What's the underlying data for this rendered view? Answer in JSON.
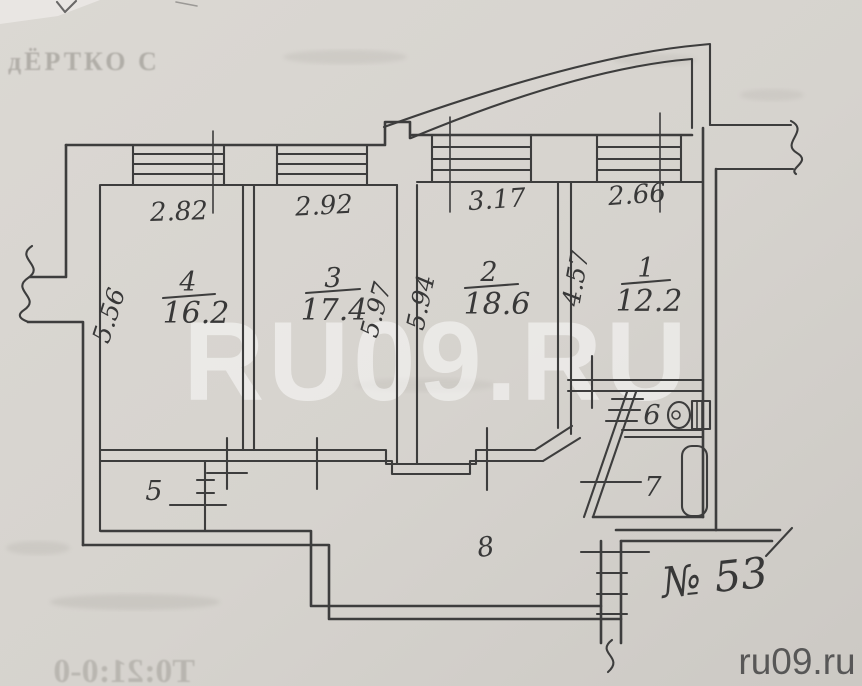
{
  "document": {
    "kind": "scanned apartment floor plan",
    "apartment_no": "№ 53"
  },
  "plan": {
    "rooms_main": [
      {
        "number": "4",
        "area": "16.2",
        "width_dim": "2.82",
        "depth_dim": "5.56"
      },
      {
        "number": "3",
        "area": "17.4",
        "width_dim": "2.92",
        "depth_dim": "5.97"
      },
      {
        "number": "2",
        "area": "18.6",
        "width_dim": "3.17",
        "depth_dim": "5.94"
      },
      {
        "number": "1",
        "area": "12.2",
        "width_dim": "2.66",
        "depth_dim": "4.57"
      }
    ],
    "rooms_other": [
      {
        "number": "5"
      },
      {
        "number": "6"
      },
      {
        "number": "7"
      },
      {
        "number": "8"
      }
    ]
  },
  "watermarks": {
    "center": "RU09.RU",
    "corner": "ru09.ru"
  },
  "bleed_text": {
    "top_left": "дЁРТКО С",
    "bottom_left": "Т0:21:0-0"
  },
  "colors": {
    "ink": "#3d3d3d",
    "paper": "#d6d3ce",
    "watermark_corner": "#4e4e4e"
  }
}
